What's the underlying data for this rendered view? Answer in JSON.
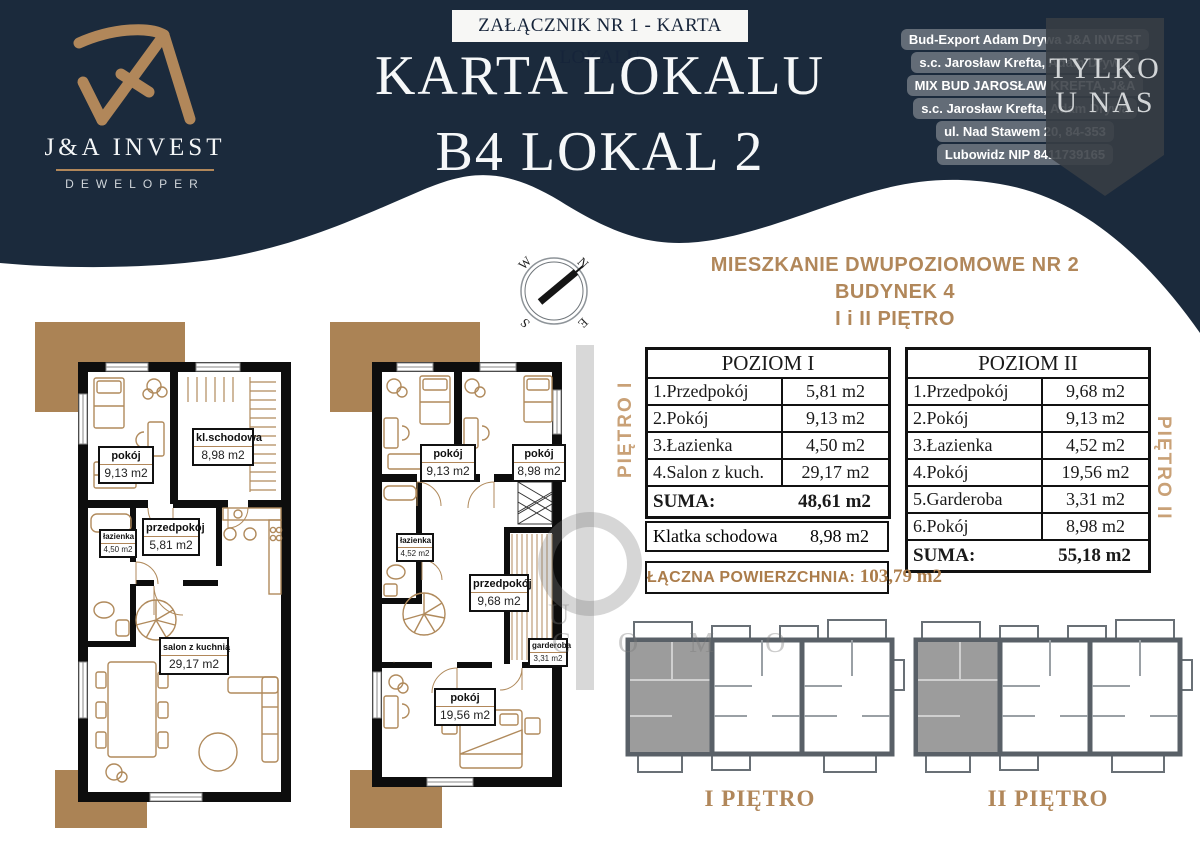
{
  "colors": {
    "navy": "#1b2a3c",
    "gold": "#b1875a",
    "tan": "#ab8355",
    "wall": "#0d0d0d",
    "furniture": "#b08a5c"
  },
  "logo": {
    "brand": "J&A INVEST",
    "subtitle": "DEWELOPER"
  },
  "header": {
    "badge": "ZAŁĄCZNIK NR 1 - KARTA LOKALU",
    "title_line1": "KARTA LOKALU",
    "title_line2": "B4 LOKAL 2"
  },
  "company": {
    "lines": [
      "Bud-Export Adam Drywa J&A INVEST",
      "s.c. Jarosław Krefta, Adam Drywa,",
      "MIX BUD JAROSŁAW KREFTA, J&A",
      "s.c. Jarosław Krefta, Adam Drywa",
      "ul. Nad Stawem 20, 84-353",
      "Lubowidz NIP 8411739165"
    ]
  },
  "ribbon": {
    "line1": "TYLKO",
    "line2": "U NAS"
  },
  "listing": {
    "heading_line1": "MIESZKANIE DWUPOZIOMOWE NR 2",
    "heading_line2": "BUDYNEK 4",
    "heading_line3": "I i II PIĘTRO"
  },
  "compass": {
    "n": "N",
    "e": "E",
    "s": "S",
    "w": "W"
  },
  "tables": {
    "poziom1": {
      "title": "POZIOM I",
      "side_label": "PIĘTRO I",
      "rows": [
        {
          "name": "1.Przedpokój",
          "area": "5,81 m2"
        },
        {
          "name": "2.Pokój",
          "area": "9,13 m2"
        },
        {
          "name": "3.Łazienka",
          "area": "4,50 m2"
        },
        {
          "name": "4.Salon z kuch.",
          "area": "29,17 m2"
        }
      ],
      "suma_label": "SUMA:",
      "suma_value": "48,61 m2"
    },
    "poziom2": {
      "title": "POZIOM II",
      "side_label": "PIĘTRO II",
      "rows": [
        {
          "name": "1.Przedpokój",
          "area": "9,68 m2"
        },
        {
          "name": "2.Pokój",
          "area": "9,13 m2"
        },
        {
          "name": "3.Łazienka",
          "area": "4,52 m2"
        },
        {
          "name": "4.Pokój",
          "area": "19,56 m2"
        },
        {
          "name": "5.Garderoba",
          "area": "3,31 m2"
        },
        {
          "name": "6.Pokój",
          "area": "8,98 m2"
        }
      ],
      "suma_label": "SUMA:",
      "suma_value": "55,18 m2"
    },
    "klatka": {
      "name": "Klatka schodowa",
      "area": "8,98 m2"
    },
    "total": {
      "label": "ŁĄCZNA POWIERZCHNIA:",
      "value": "103,79 m2"
    }
  },
  "plans": {
    "plan1": {
      "rooms": [
        {
          "name": "pokój",
          "area": "9,13 m2"
        },
        {
          "name": "kl.schodowa",
          "area": "8,98 m2"
        },
        {
          "name": "łazienka",
          "area": "4,50 m2"
        },
        {
          "name": "przedpokój",
          "area": "5,81 m2"
        },
        {
          "name": "salon z kuchnią",
          "area": "29,17 m2"
        }
      ]
    },
    "plan2": {
      "rooms": [
        {
          "name": "pokój",
          "area": "9,13 m2"
        },
        {
          "name": "pokój",
          "area": "8,98 m2"
        },
        {
          "name": "łazienka",
          "area": "4,52 m2"
        },
        {
          "name": "przedpokój",
          "area": "9,68 m2"
        },
        {
          "name": "garderoba",
          "area": "3,31 m2"
        },
        {
          "name": "pokój",
          "area": "19,56 m2"
        }
      ]
    }
  },
  "mini_plans": [
    {
      "label": "I PIĘTRO"
    },
    {
      "label": "II PIĘTRO"
    }
  ],
  "watermark": {
    "fragments": [
      "U",
      "C",
      "O M O"
    ]
  }
}
